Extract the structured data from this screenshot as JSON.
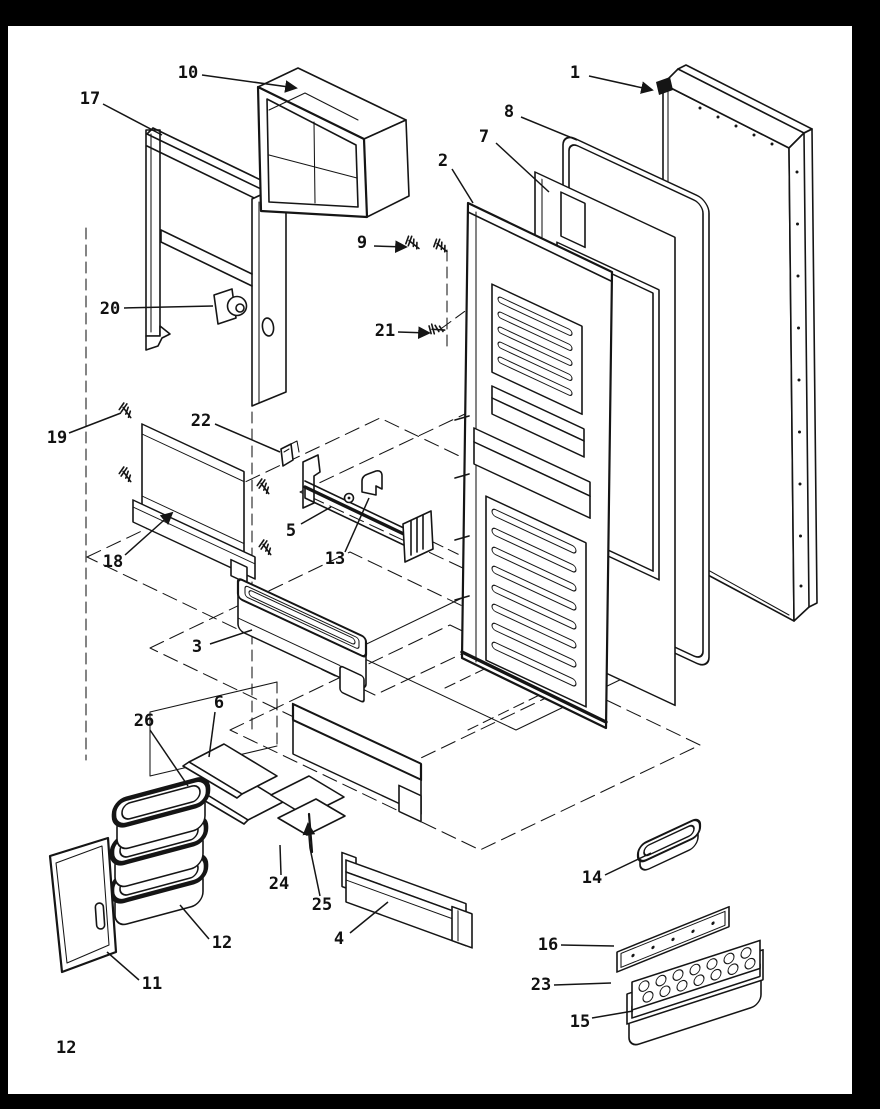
{
  "page": {
    "number": "12",
    "background": "#ffffff",
    "border_color": "#000000",
    "ink_color": "#151515"
  },
  "diagram": {
    "type": "exploded-parts-diagram",
    "subject": "Refrigerator door assembly exploded view",
    "style": "black-and-white technical line drawing",
    "parts": [
      {
        "num": "1",
        "name": "refrigerator-door-outer-panel",
        "label_x": 575,
        "label_y": 73,
        "leader": [
          [
            589,
            76
          ],
          [
            652,
            90
          ]
        ],
        "arrow": true
      },
      {
        "num": "8",
        "name": "door-gasket",
        "label_x": 509,
        "label_y": 112,
        "leader": [
          [
            521,
            117
          ],
          [
            577,
            140
          ]
        ],
        "arrow": false
      },
      {
        "num": "7",
        "name": "inner-door-panel",
        "label_x": 484,
        "label_y": 137,
        "leader": [
          [
            496,
            143
          ],
          [
            549,
            192
          ]
        ],
        "arrow": false
      },
      {
        "num": "2",
        "name": "refrigerator-door-liner",
        "label_x": 443,
        "label_y": 161,
        "leader": [
          [
            452,
            169
          ],
          [
            473,
            203
          ]
        ],
        "arrow": false
      },
      {
        "num": "9",
        "name": "screw",
        "label_x": 362,
        "label_y": 243,
        "leader": [
          [
            374,
            246
          ],
          [
            406,
            247
          ]
        ],
        "arrow": true
      },
      {
        "num": "10",
        "name": "dairy-compartment",
        "label_x": 188,
        "label_y": 73,
        "leader": [
          [
            202,
            75
          ],
          [
            296,
            88
          ]
        ],
        "arrow": true
      },
      {
        "num": "17",
        "name": "door-shelf-frame",
        "label_x": 90,
        "label_y": 99,
        "leader": [
          [
            103,
            104
          ],
          [
            162,
            135
          ]
        ],
        "arrow": false
      },
      {
        "num": "20",
        "name": "door-closure-cam",
        "label_x": 110,
        "label_y": 309,
        "leader": [
          [
            124,
            308
          ],
          [
            213,
            306
          ]
        ],
        "arrow": false
      },
      {
        "num": "21",
        "name": "screw",
        "label_x": 385,
        "label_y": 331,
        "leader": [
          [
            398,
            332
          ],
          [
            429,
            333
          ]
        ],
        "arrow": true
      },
      {
        "num": "19",
        "name": "screw",
        "label_x": 57,
        "label_y": 438,
        "leader": [
          [
            69,
            433
          ],
          [
            121,
            413
          ]
        ],
        "arrow": false
      },
      {
        "num": "22",
        "name": "retainer-clip",
        "label_x": 201,
        "label_y": 421,
        "leader": [
          [
            215,
            424
          ],
          [
            280,
            452
          ]
        ],
        "arrow": false
      },
      {
        "num": "18",
        "name": "cover-panel",
        "label_x": 113,
        "label_y": 562,
        "leader": [
          [
            125,
            555
          ],
          [
            172,
            513
          ]
        ],
        "arrow": true
      },
      {
        "num": "5",
        "name": "shelf-rail",
        "label_x": 291,
        "label_y": 531,
        "leader": [
          [
            301,
            524
          ],
          [
            331,
            507
          ]
        ],
        "arrow": false
      },
      {
        "num": "13",
        "name": "rail-latch",
        "label_x": 335,
        "label_y": 559,
        "leader": [
          [
            345,
            552
          ],
          [
            369,
            498
          ]
        ],
        "arrow": false
      },
      {
        "num": "3",
        "name": "door-shelf-bucket",
        "label_x": 197,
        "label_y": 647,
        "leader": [
          [
            210,
            644
          ],
          [
            252,
            630
          ]
        ],
        "arrow": false
      },
      {
        "num": "6",
        "name": "shelf-insert",
        "label_x": 219,
        "label_y": 703,
        "leader": [
          [
            215,
            712
          ],
          [
            209,
            757
          ]
        ],
        "arrow": false
      },
      {
        "num": "26",
        "name": "shelf-panel",
        "label_x": 144,
        "label_y": 721,
        "leader": [
          [
            150,
            730
          ],
          [
            188,
            786
          ]
        ],
        "arrow": false
      },
      {
        "num": "24",
        "name": "utility-shelf",
        "label_x": 279,
        "label_y": 884,
        "leader": [
          [
            281,
            875
          ],
          [
            280,
            845
          ]
        ],
        "arrow": false
      },
      {
        "num": "25",
        "name": "shelf-retainer-pin",
        "label_x": 322,
        "label_y": 905,
        "leader": [
          [
            320,
            896
          ],
          [
            310,
            848
          ],
          [
            308,
            824
          ]
        ],
        "arrow": true
      },
      {
        "num": "12",
        "name": "crisper-container-stack",
        "label_x": 222,
        "label_y": 943,
        "leader": [
          [
            209,
            939
          ],
          [
            180,
            905
          ]
        ],
        "arrow": false
      },
      {
        "num": "11",
        "name": "access-panel",
        "label_x": 152,
        "label_y": 984,
        "leader": [
          [
            139,
            980
          ],
          [
            107,
            952
          ]
        ],
        "arrow": false
      },
      {
        "num": "4",
        "name": "door-shelf",
        "label_x": 339,
        "label_y": 939,
        "leader": [
          [
            350,
            933
          ],
          [
            388,
            902
          ]
        ],
        "arrow": false
      },
      {
        "num": "14",
        "name": "utility-tray",
        "label_x": 592,
        "label_y": 878,
        "leader": [
          [
            605,
            875
          ],
          [
            651,
            853
          ]
        ],
        "arrow": false
      },
      {
        "num": "16",
        "name": "ice-bin-lid",
        "label_x": 548,
        "label_y": 945,
        "leader": [
          [
            561,
            945
          ],
          [
            614,
            946
          ]
        ],
        "arrow": false
      },
      {
        "num": "23",
        "name": "ice-cube-tray",
        "label_x": 541,
        "label_y": 985,
        "leader": [
          [
            554,
            985
          ],
          [
            611,
            983
          ]
        ],
        "arrow": false
      },
      {
        "num": "15",
        "name": "ice-bin",
        "label_x": 580,
        "label_y": 1022,
        "leader": [
          [
            592,
            1018
          ],
          [
            633,
            1011
          ]
        ],
        "arrow": false
      }
    ]
  }
}
